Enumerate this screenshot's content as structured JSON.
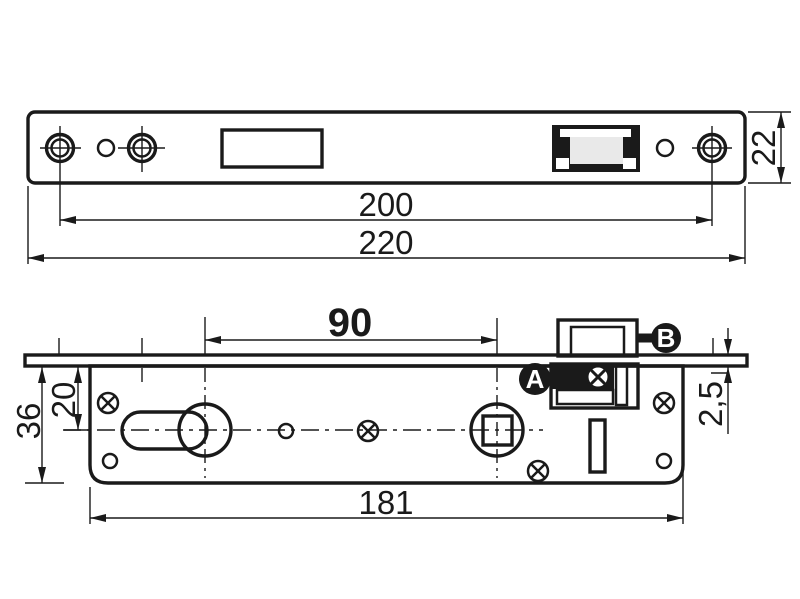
{
  "drawing": {
    "kind": "technical dimension drawing, two orthographic views of a narrow-stile mortise lock",
    "dims": {
      "d220": "220",
      "d200": "200",
      "d22": "22",
      "d90": "90",
      "d181": "181",
      "d36": "36",
      "d20": "20",
      "d2_5": "2,5"
    },
    "callouts": {
      "a": "A",
      "b": "B"
    },
    "symbols": {
      "countersunk_screw_hole": "double circle with crosshair",
      "screw": "circle with diagonal cross",
      "cylinder_hole": "euro-profile keyhole (circle + oblong)",
      "spindle_hole": "square in circle",
      "latch_bolt": "rectangular latch with callouts A and B"
    },
    "colors": {
      "line": "#1a1a1a",
      "plate_fill": "#e9e9e9",
      "strip_fill": "#f7f7f7",
      "hole_fill": "#ffffff",
      "background": "#ffffff"
    }
  }
}
